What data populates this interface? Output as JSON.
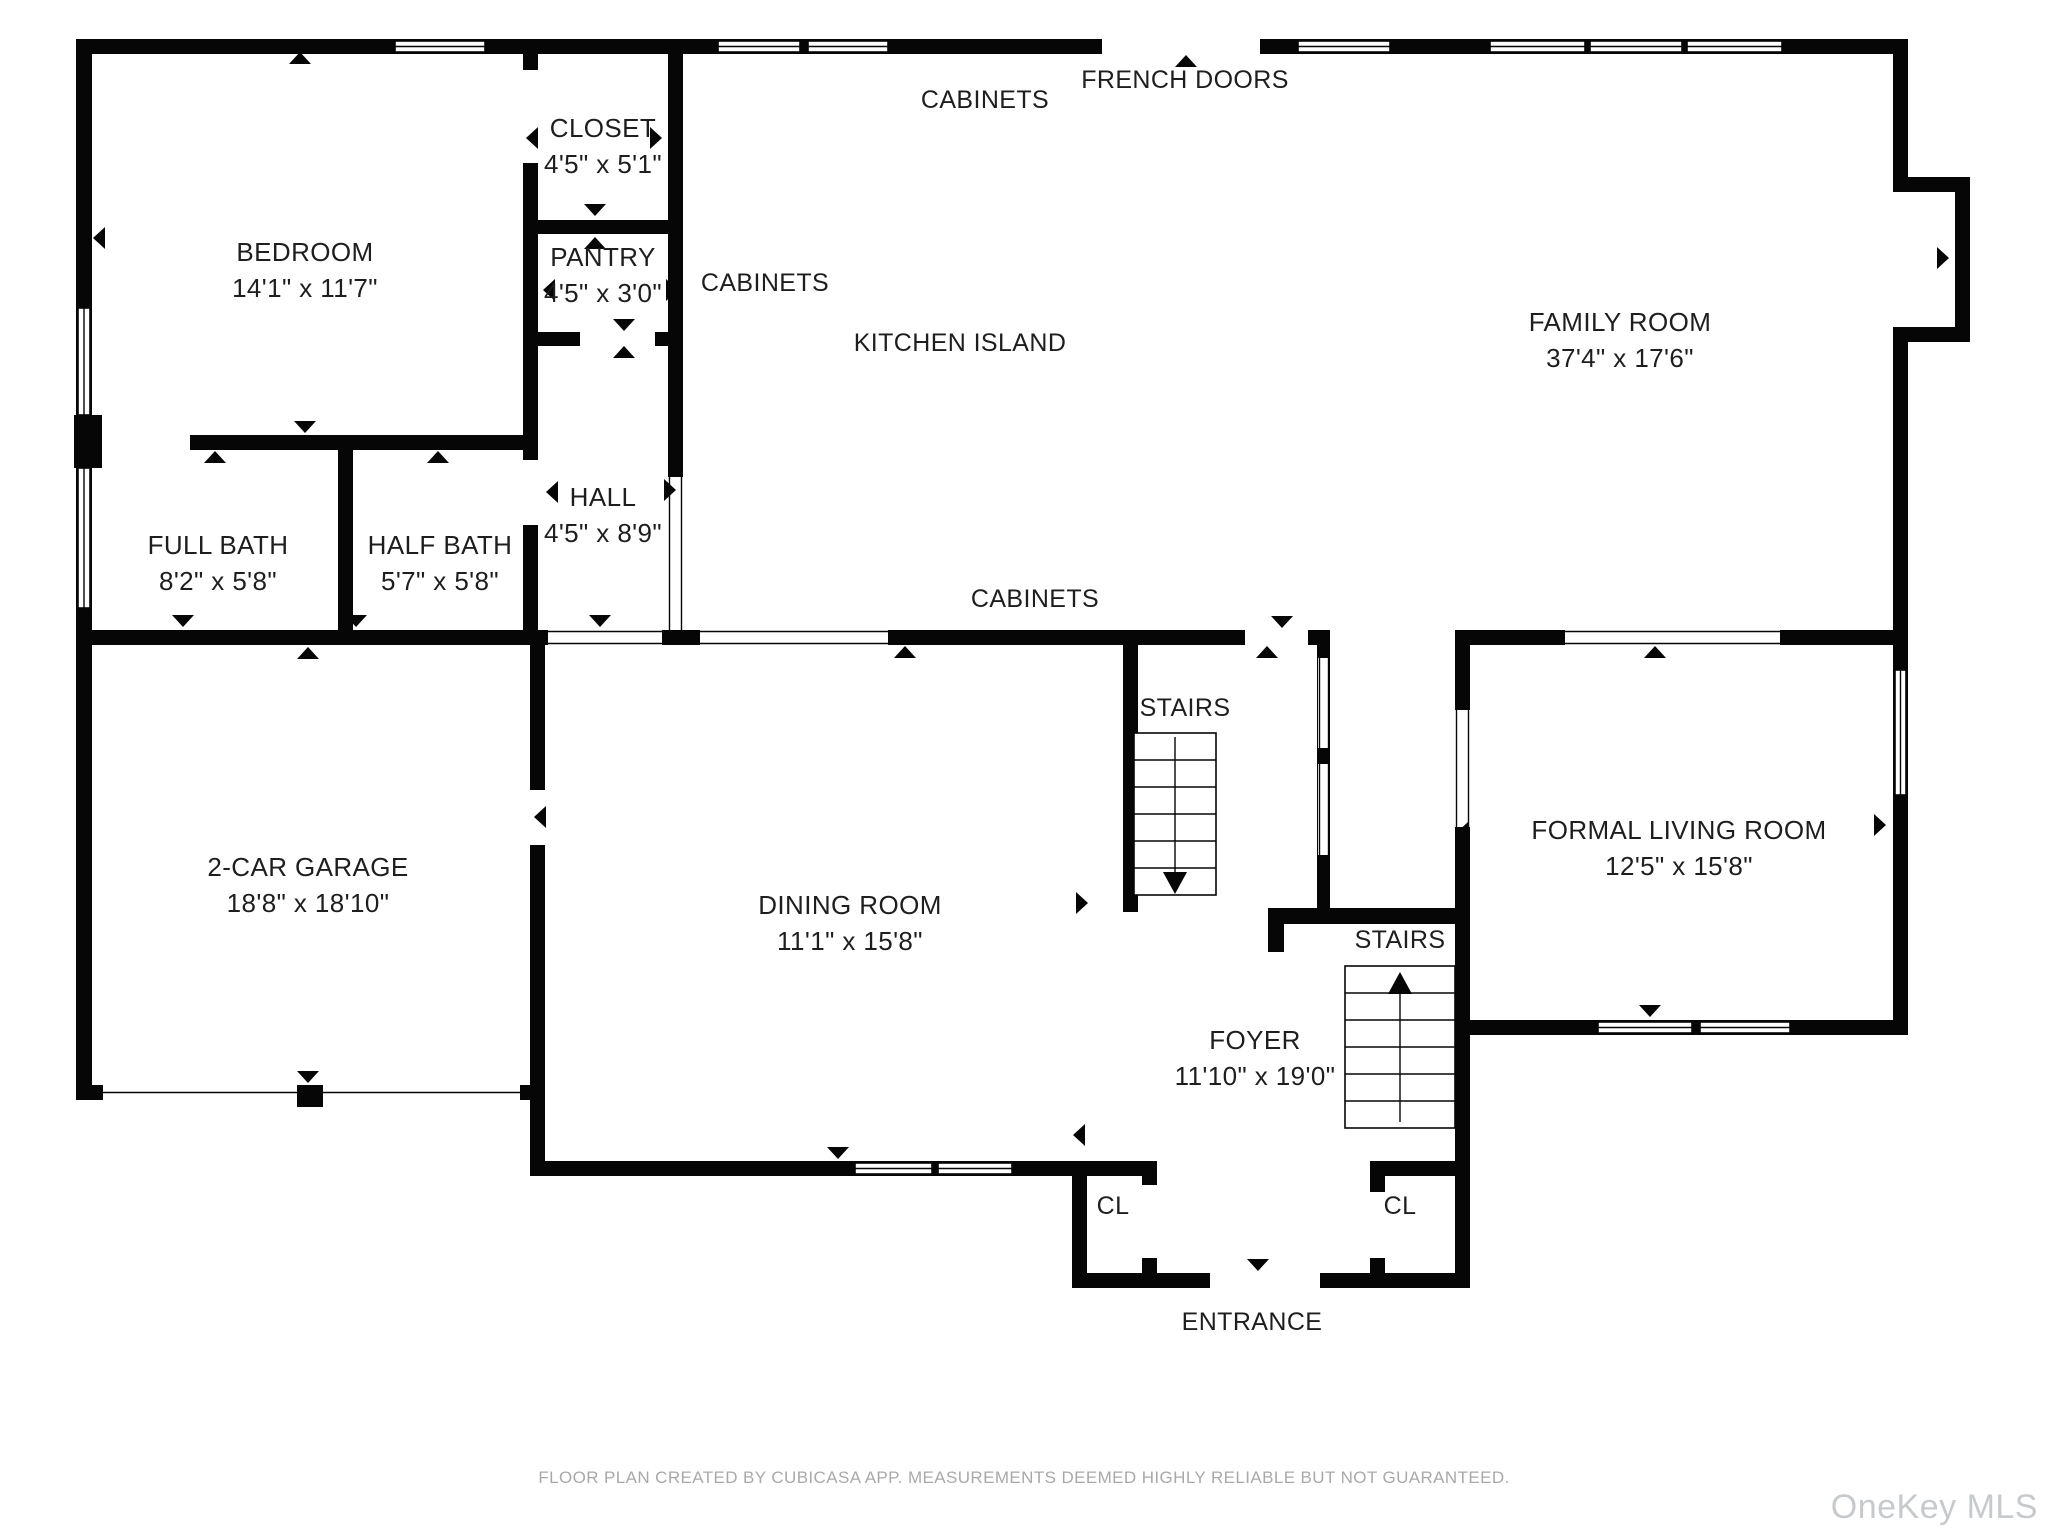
{
  "plan": {
    "wall_color": "#060606",
    "background_color": "#ffffff",
    "label_color": "#1e1e1e",
    "rooms": [
      {
        "id": "bedroom",
        "name": "BEDROOM",
        "dims": "14'1\" x 11'7\""
      },
      {
        "id": "closet",
        "name": "CLOSET",
        "dims": "4'5\" x 5'1\""
      },
      {
        "id": "pantry",
        "name": "PANTRY",
        "dims": "4'5\" x 3'0\""
      },
      {
        "id": "full-bath",
        "name": "FULL BATH",
        "dims": "8'2\" x 5'8\""
      },
      {
        "id": "half-bath",
        "name": "HALF BATH",
        "dims": "5'7\" x 5'8\""
      },
      {
        "id": "hall",
        "name": "HALL",
        "dims": "4'5\" x 8'9\""
      },
      {
        "id": "family-room",
        "name": "FAMILY ROOM",
        "dims": "37'4\" x 17'6\""
      },
      {
        "id": "garage",
        "name": "2-CAR GARAGE",
        "dims": "18'8\" x 18'10\""
      },
      {
        "id": "dining-room",
        "name": "DINING ROOM",
        "dims": "11'1\" x 15'8\""
      },
      {
        "id": "foyer",
        "name": "FOYER",
        "dims": "11'10\" x 19'0\""
      },
      {
        "id": "formal-living-room",
        "name": "FORMAL LIVING ROOM",
        "dims": "12'5\" x 15'8\""
      }
    ],
    "annotations": [
      {
        "id": "cabinets-top",
        "text": "CABINETS"
      },
      {
        "id": "french-doors",
        "text": "FRENCH DOORS"
      },
      {
        "id": "cabinets-kitchen",
        "text": "CABINETS"
      },
      {
        "id": "kitchen-island",
        "text": "KITCHEN ISLAND"
      },
      {
        "id": "cabinets-island",
        "text": "CABINETS"
      },
      {
        "id": "stairs-down",
        "text": "STAIRS"
      },
      {
        "id": "stairs-up",
        "text": "STAIRS"
      },
      {
        "id": "closet-left",
        "text": "CL"
      },
      {
        "id": "closet-right",
        "text": "CL"
      },
      {
        "id": "entrance",
        "text": "ENTRANCE"
      }
    ]
  },
  "footer": {
    "disclaimer": "FLOOR PLAN CREATED BY CUBICASA APP. MEASUREMENTS DEEMED HIGHLY RELIABLE BUT NOT GUARANTEED.",
    "watermark": "OneKey MLS"
  }
}
